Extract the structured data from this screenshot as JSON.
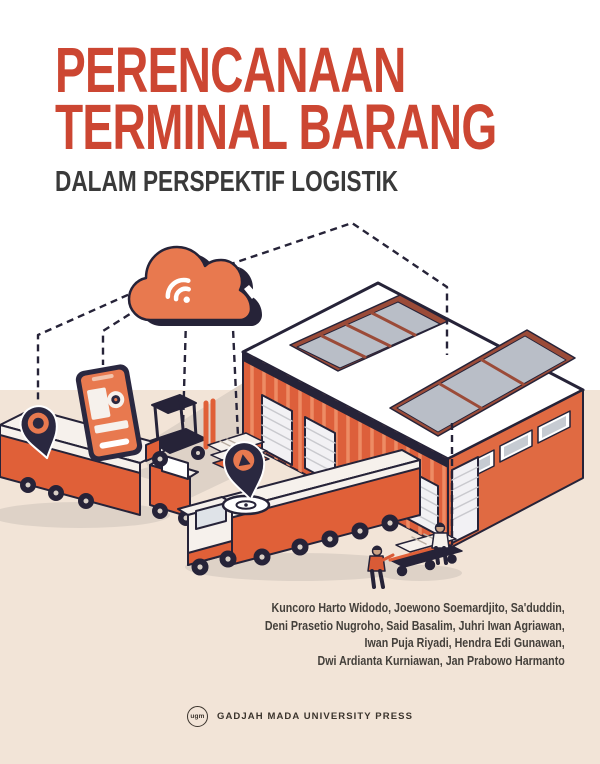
{
  "cover": {
    "title_line1": "PERENCANAAN",
    "title_line2": "TERMINAL BARANG",
    "subtitle": "DALAM PERSPEKTIF LOGISTIK",
    "authors": [
      "Kuncoro Harto Widodo, Joewono Soemardjito, Sa'duddin,",
      "Deni Prasetio Nugroho, Said Basalim, Juhri Iwan Agriawan,",
      "Iwan Puja Riyadi, Hendra Edi Gunawan,",
      "Dwi Ardianta Kurniawan, Jan Prabowo Harmanto"
    ],
    "publisher": {
      "logo_text": "ugm",
      "name": "GADJAH MADA UNIVERSITY PRESS"
    }
  },
  "illustration": {
    "scene": "isometric freight terminal with cloud connectivity",
    "elements": [
      "cloud-wifi",
      "warehouse-with-skylights",
      "delivery-truck-left",
      "delivery-truck-docking",
      "forklift-with-pallet",
      "smartphone-tracking-app",
      "location-pin-left",
      "location-pin-center",
      "workers-with-cart",
      "dashed-data-links"
    ]
  },
  "colors": {
    "title_red": "#CC4632",
    "subtitle_dark": "#3A3A3A",
    "accent_orange": "#E0703F",
    "dark_navy": "#262338",
    "ground_beige": "#F2E4D7",
    "background": "#FFFFFF",
    "authors_text": "#44403B"
  }
}
